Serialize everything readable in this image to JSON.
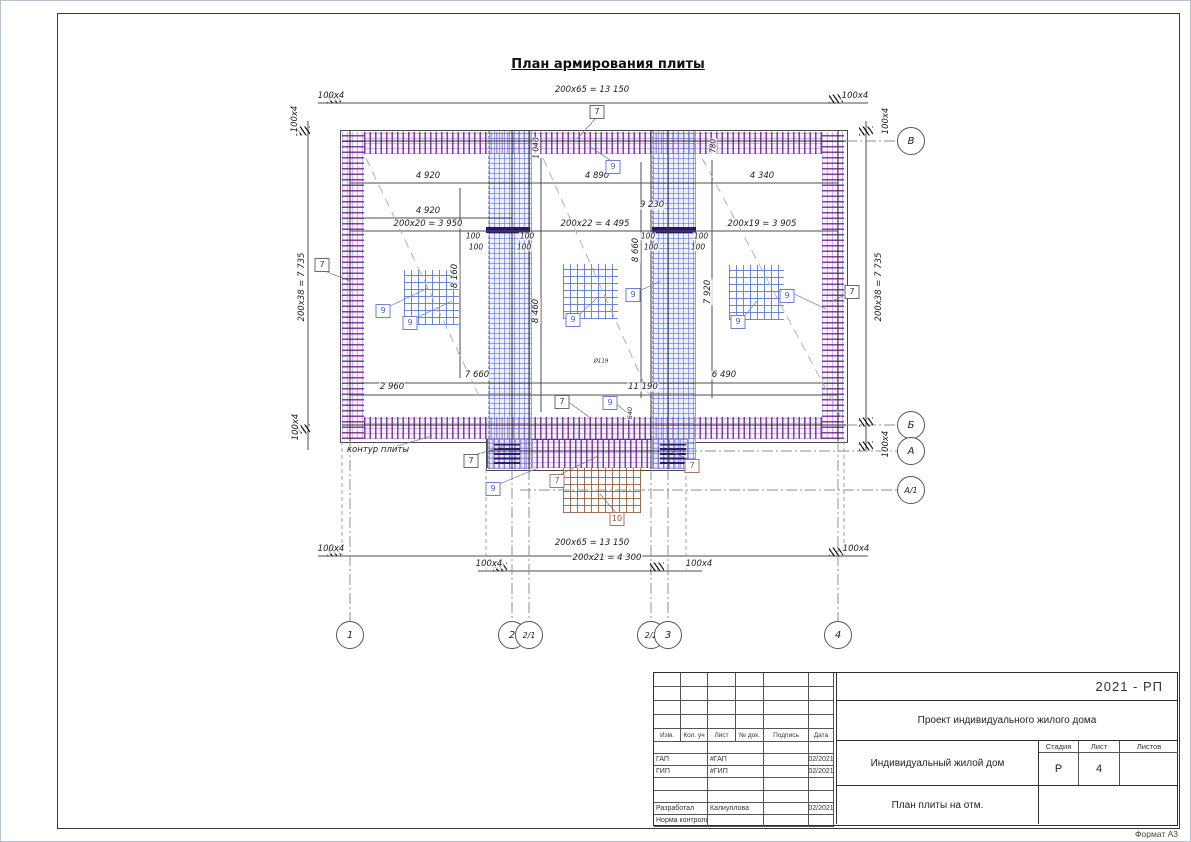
{
  "sheet": {
    "title": "План армирования плиты",
    "format": "Формат А3"
  },
  "colors": {
    "rebar_purple": "#761c94",
    "rebar_blue": "#4e5ecd",
    "mesh_brown": "#94644a",
    "line_dark": "#333333"
  },
  "axes": {
    "bottom": [
      {
        "label": "1",
        "x": 350
      },
      {
        "label": "2",
        "x": 512
      },
      {
        "label": "2/1",
        "x": 529
      },
      {
        "label": "2/2",
        "x": 651
      },
      {
        "label": "3",
        "x": 668
      },
      {
        "label": "4",
        "x": 838
      }
    ],
    "right": [
      {
        "label": "В",
        "y": 141
      },
      {
        "label": "Б",
        "y": 425
      },
      {
        "label": "А",
        "y": 451
      },
      {
        "label": "А/1",
        "y": 490
      }
    ]
  },
  "dim_labels": [
    {
      "t": "100x4",
      "x": 331,
      "y": 96
    },
    {
      "t": "200x65 = 13 150",
      "x": 592,
      "y": 90
    },
    {
      "t": "100x4",
      "x": 855,
      "y": 96
    },
    {
      "t": "100x4",
      "x": 295,
      "y": 119,
      "r": -90
    },
    {
      "t": "100x4",
      "x": 886,
      "y": 121,
      "r": -90
    },
    {
      "t": "200x38 = 7 735",
      "x": 302,
      "y": 287,
      "r": -90
    },
    {
      "t": "200x38 = 7 735",
      "x": 879,
      "y": 287,
      "r": -90
    },
    {
      "t": "100x4",
      "x": 296,
      "y": 427,
      "r": -90
    },
    {
      "t": "100x4",
      "x": 886,
      "y": 444,
      "r": -90
    },
    {
      "t": "4 920",
      "x": 428,
      "y": 176
    },
    {
      "t": "4 890",
      "x": 597,
      "y": 176
    },
    {
      "t": "4 340",
      "x": 762,
      "y": 176
    },
    {
      "t": "4 920",
      "x": 428,
      "y": 211
    },
    {
      "t": "9 230",
      "x": 652,
      "y": 205
    },
    {
      "t": "200x20 = 3 950",
      "x": 428,
      "y": 224
    },
    {
      "t": "200x22 = 4 495",
      "x": 595,
      "y": 224
    },
    {
      "t": "200x19 = 3 905",
      "x": 762,
      "y": 224
    },
    {
      "t": "100",
      "x": 473,
      "y": 236,
      "s": 7.5
    },
    {
      "t": "100",
      "x": 527,
      "y": 236,
      "s": 7.5
    },
    {
      "t": "100",
      "x": 476,
      "y": 247,
      "s": 7.5
    },
    {
      "t": "100",
      "x": 524,
      "y": 247,
      "s": 7.5
    },
    {
      "t": "100",
      "x": 648,
      "y": 236,
      "s": 7.5
    },
    {
      "t": "100",
      "x": 701,
      "y": 236,
      "s": 7.5
    },
    {
      "t": "100",
      "x": 651,
      "y": 247,
      "s": 7.5
    },
    {
      "t": "100",
      "x": 698,
      "y": 247,
      "s": 7.5
    },
    {
      "t": "1 040",
      "x": 536,
      "y": 148,
      "r": -90,
      "s": 7.5
    },
    {
      "t": "780",
      "x": 713,
      "y": 146,
      "r": -90,
      "s": 7.5
    },
    {
      "t": "8 160",
      "x": 455,
      "y": 276,
      "r": -90
    },
    {
      "t": "8 460",
      "x": 536,
      "y": 311,
      "r": -90
    },
    {
      "t": "8 660",
      "x": 636,
      "y": 250,
      "r": -90
    },
    {
      "t": "7 920",
      "x": 708,
      "y": 292,
      "r": -90
    },
    {
      "t": "7 660",
      "x": 477,
      "y": 375
    },
    {
      "t": "6 490",
      "x": 724,
      "y": 375
    },
    {
      "t": "2 960",
      "x": 392,
      "y": 387
    },
    {
      "t": "11 190",
      "x": 643,
      "y": 387
    },
    {
      "t": "640",
      "x": 630,
      "y": 413,
      "r": -90,
      "s": 6.5
    },
    {
      "t": "100x4",
      "x": 331,
      "y": 549
    },
    {
      "t": "200x65 = 13 150",
      "x": 592,
      "y": 543
    },
    {
      "t": "100x4",
      "x": 856,
      "y": 549
    },
    {
      "t": "100x4",
      "x": 489,
      "y": 564
    },
    {
      "t": "200x21 = 4 300",
      "x": 607,
      "y": 558
    },
    {
      "t": "100x4",
      "x": 699,
      "y": 564
    }
  ],
  "notes": [
    {
      "t": "контур плиты",
      "x": 378,
      "y": 450,
      "s": 8.5
    },
    {
      "t": "Ø119",
      "x": 601,
      "y": 362,
      "s": 5.5
    }
  ],
  "callouts": [
    {
      "t": "7",
      "x": 597,
      "y": 112,
      "c": "k"
    },
    {
      "t": "9",
      "x": 613,
      "y": 167,
      "c": "b"
    },
    {
      "t": "7",
      "x": 322,
      "y": 265,
      "c": "k"
    },
    {
      "t": "7",
      "x": 852,
      "y": 292,
      "c": "k"
    },
    {
      "t": "9",
      "x": 383,
      "y": 311,
      "c": "b"
    },
    {
      "t": "9",
      "x": 410,
      "y": 323,
      "c": "b"
    },
    {
      "t": "9",
      "x": 573,
      "y": 320,
      "c": "b"
    },
    {
      "t": "9",
      "x": 633,
      "y": 295,
      "c": "b"
    },
    {
      "t": "9",
      "x": 738,
      "y": 322,
      "c": "b"
    },
    {
      "t": "9",
      "x": 787,
      "y": 296,
      "c": "b"
    },
    {
      "t": "7",
      "x": 562,
      "y": 402,
      "c": "k"
    },
    {
      "t": "9",
      "x": 610,
      "y": 403,
      "c": "b"
    },
    {
      "t": "7",
      "x": 471,
      "y": 461,
      "c": "k"
    },
    {
      "t": "9",
      "x": 493,
      "y": 489,
      "c": "b"
    },
    {
      "t": "7",
      "x": 557,
      "y": 481,
      "c": "n"
    },
    {
      "t": "7",
      "x": 692,
      "y": 466,
      "c": "n"
    },
    {
      "t": "10",
      "x": 617,
      "y": 519,
      "c": "n"
    }
  ],
  "title_block": {
    "code": "2021 - РП",
    "project": "Проект индивидуального жилого дома",
    "object": "Индивидуальный жилой дом",
    "sheet_name": "План плиты на отм.",
    "stage_header": [
      "Стадия",
      "Лист",
      "Листов"
    ],
    "stage_values": [
      "Р",
      "4",
      ""
    ],
    "columns": [
      "Изм.",
      "Кол. уч",
      "Лист",
      "№ док.",
      "Подпись",
      "Дата"
    ],
    "sig_rows": [
      [
        "",
        "",
        "",
        ""
      ],
      [
        "ГАП",
        "#ГАП",
        "",
        "02/2021"
      ],
      [
        "ГИП",
        "#ГИП",
        "",
        "02/2021"
      ],
      [
        "",
        "",
        "",
        ""
      ],
      [
        "",
        "",
        "",
        ""
      ],
      [
        "Разработал",
        "Калиуллова",
        "",
        "02/2021"
      ],
      [
        "Норма контроль",
        "",
        "",
        ""
      ]
    ]
  }
}
